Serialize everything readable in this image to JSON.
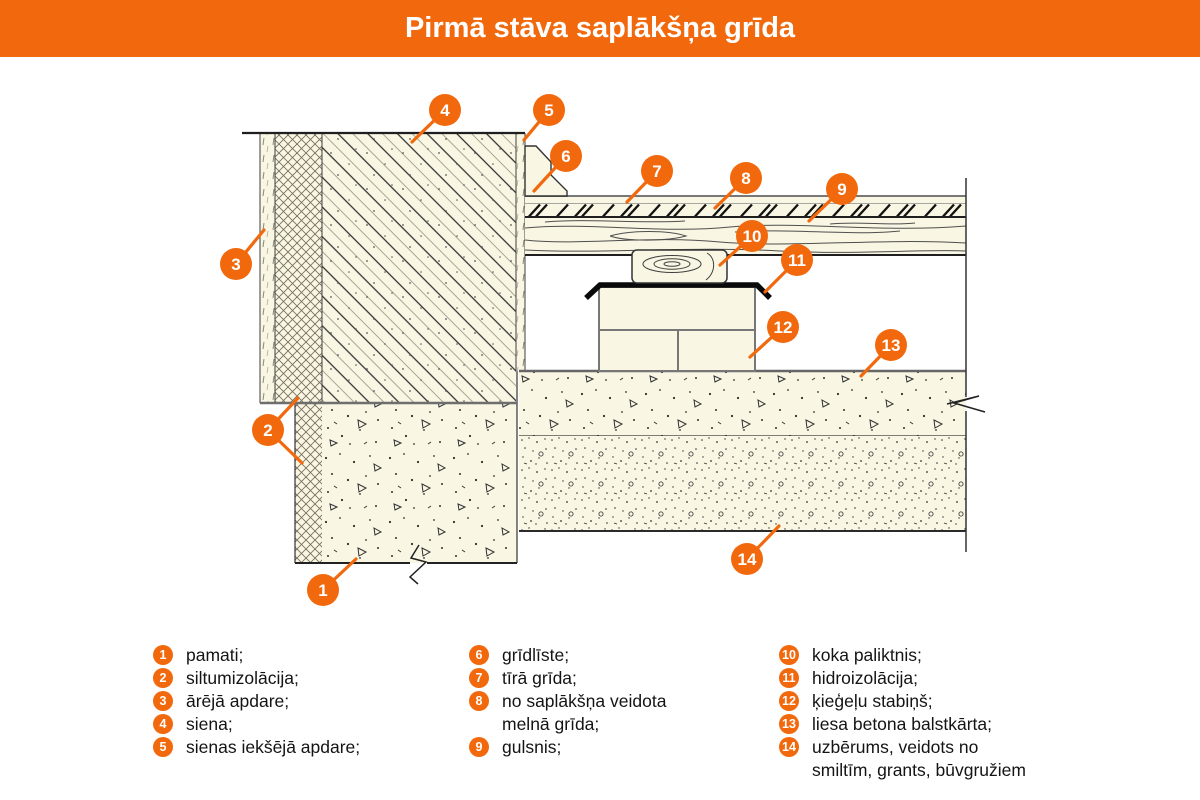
{
  "title": "Pirmā stāva saplākšņa grīda",
  "colors": {
    "accent": "#F2690D",
    "material": "#F9F6E3",
    "ink": "#1F1F1F"
  },
  "legend": {
    "columns": [
      {
        "items": [
          {
            "num": "1",
            "lines": [
              "pamati;"
            ]
          },
          {
            "num": "2",
            "lines": [
              "siltumizolācija;"
            ]
          },
          {
            "num": "3",
            "lines": [
              "ārējā apdare;"
            ]
          },
          {
            "num": "4",
            "lines": [
              "siena;"
            ]
          },
          {
            "num": "5",
            "lines": [
              "sienas iekšējā apdare;"
            ]
          }
        ]
      },
      {
        "items": [
          {
            "num": "6",
            "lines": [
              "grīdlīste;"
            ]
          },
          {
            "num": "7",
            "lines": [
              "tīrā grīda;"
            ]
          },
          {
            "num": "8",
            "lines": [
              "no saplākšņa veidota",
              "melnā grīda;"
            ]
          },
          {
            "num": "9",
            "lines": [
              "gulsnis;"
            ]
          }
        ]
      },
      {
        "items": [
          {
            "num": "10",
            "lines": [
              "koka paliktnis;"
            ]
          },
          {
            "num": "11",
            "lines": [
              "hidroizolācija;"
            ]
          },
          {
            "num": "12",
            "lines": [
              "ķieģeļu stabiņš;"
            ]
          },
          {
            "num": "13",
            "lines": [
              "liesa betona balstkārta;"
            ]
          },
          {
            "num": "14",
            "lines": [
              "uzbērums, veidots no",
              "smiltīm, grants, būvgružiem"
            ]
          }
        ]
      }
    ]
  },
  "callouts": [
    {
      "num": "1",
      "cx": 323,
      "cy": 590,
      "tips": [
        [
          356,
          559
        ]
      ]
    },
    {
      "num": "2",
      "cx": 268,
      "cy": 430,
      "tips": [
        [
          298,
          398
        ],
        [
          302,
          463
        ]
      ]
    },
    {
      "num": "3",
      "cx": 236,
      "cy": 264,
      "tips": [
        [
          264,
          230
        ]
      ]
    },
    {
      "num": "4",
      "cx": 445,
      "cy": 110,
      "tips": [
        [
          412,
          142
        ]
      ]
    },
    {
      "num": "5",
      "cx": 549,
      "cy": 110,
      "tips": [
        [
          524,
          140
        ]
      ]
    },
    {
      "num": "6",
      "cx": 566,
      "cy": 156,
      "tips": [
        [
          534,
          191
        ]
      ]
    },
    {
      "num": "7",
      "cx": 657,
      "cy": 171,
      "tips": [
        [
          627,
          202
        ]
      ]
    },
    {
      "num": "8",
      "cx": 746,
      "cy": 178,
      "tips": [
        [
          715,
          208
        ]
      ]
    },
    {
      "num": "9",
      "cx": 842,
      "cy": 189,
      "tips": [
        [
          809,
          221
        ]
      ]
    },
    {
      "num": "10",
      "cx": 752,
      "cy": 236,
      "tips": [
        [
          720,
          265
        ]
      ]
    },
    {
      "num": "11",
      "cx": 797,
      "cy": 260,
      "tips": [
        [
          765,
          292
        ]
      ]
    },
    {
      "num": "12",
      "cx": 783,
      "cy": 327,
      "tips": [
        [
          750,
          357
        ]
      ]
    },
    {
      "num": "13",
      "cx": 891,
      "cy": 345,
      "tips": [
        [
          861,
          376
        ]
      ]
    },
    {
      "num": "14",
      "cx": 747,
      "cy": 559,
      "tips": [
        [
          779,
          526
        ]
      ]
    }
  ]
}
